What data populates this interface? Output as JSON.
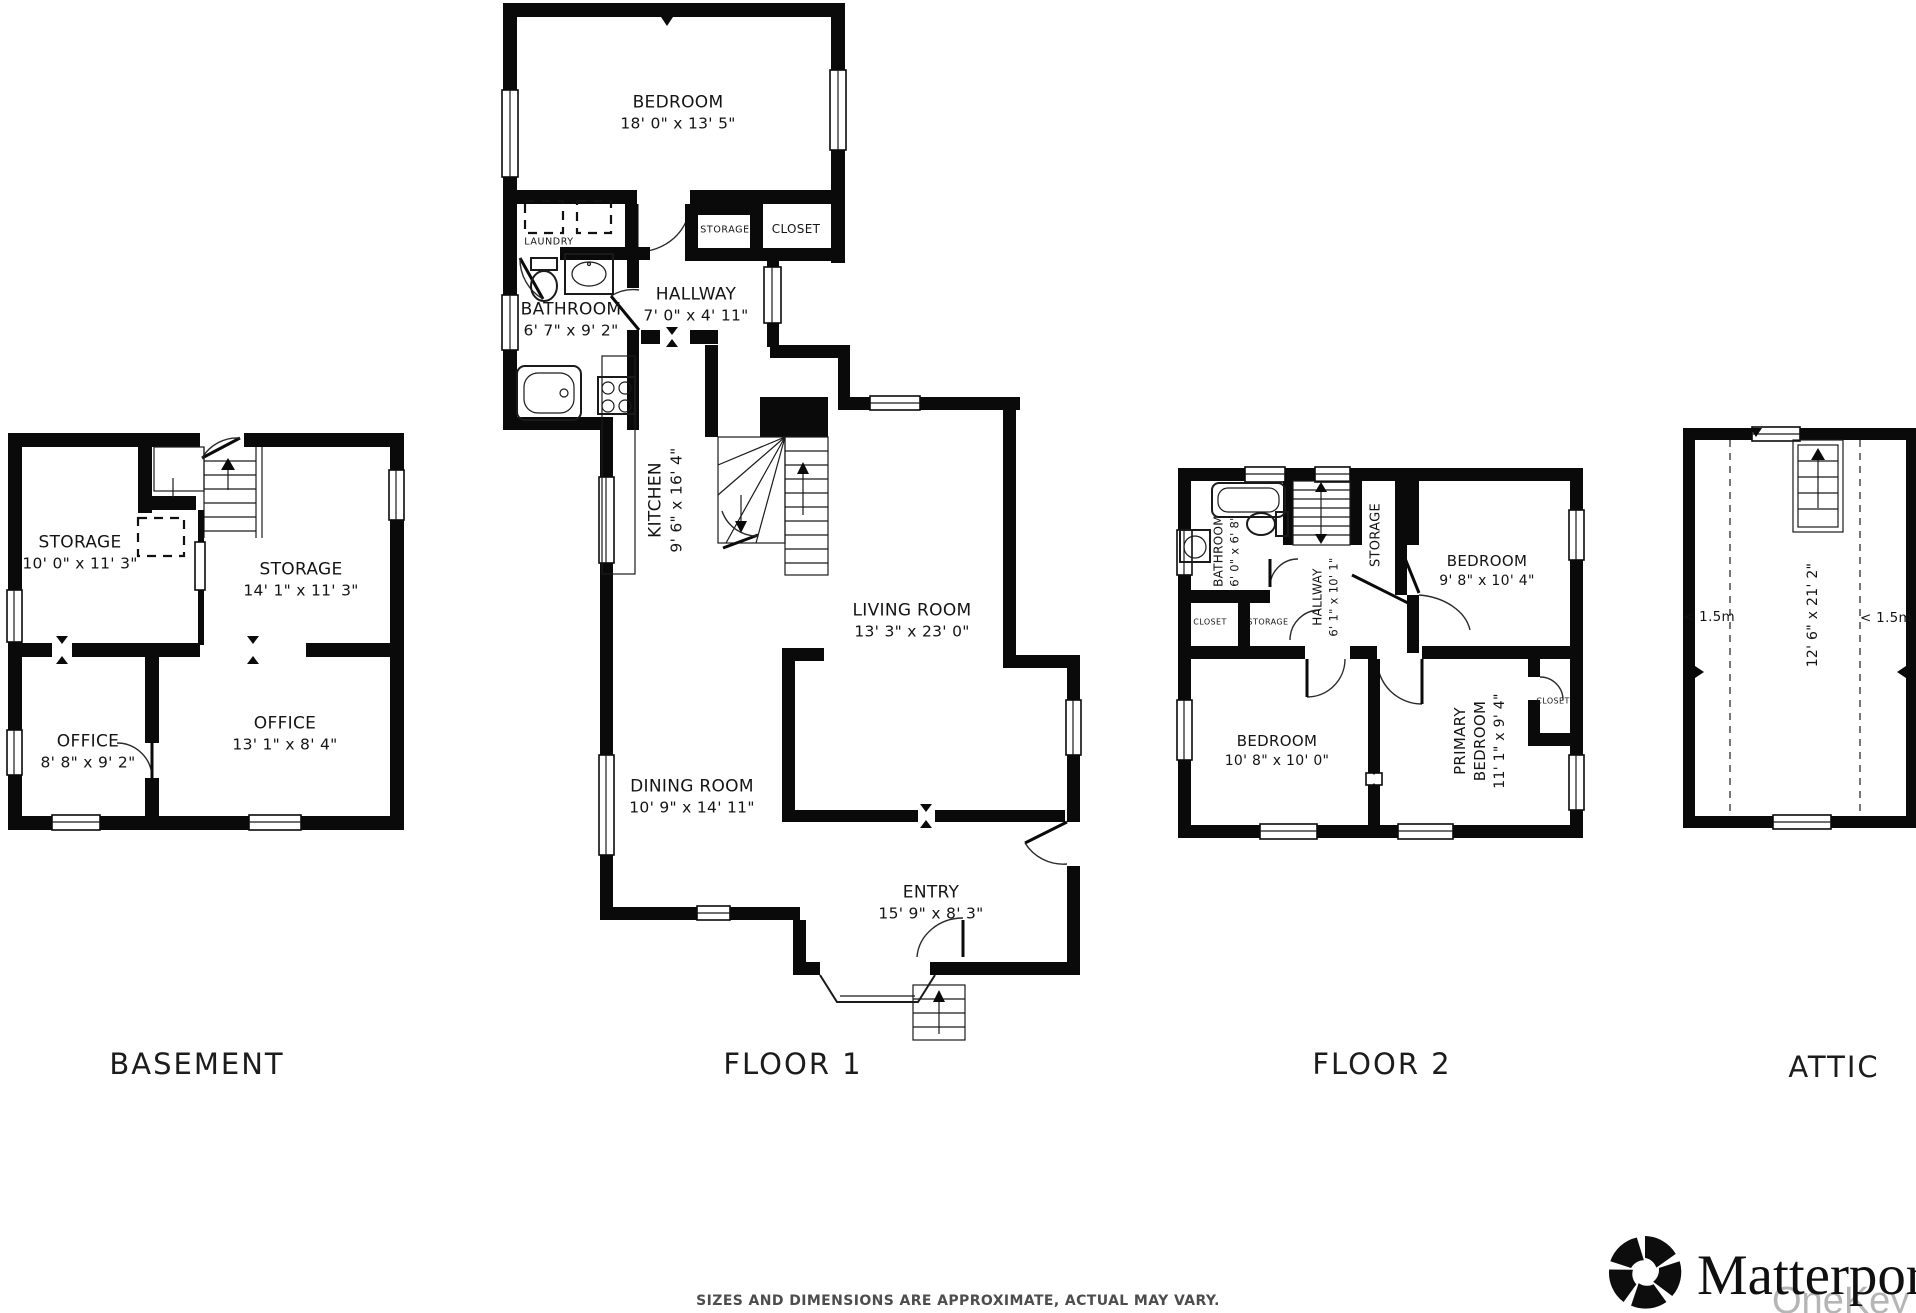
{
  "floors": {
    "basement": {
      "title": "BASEMENT",
      "storage1": {
        "name": "STORAGE",
        "dims": "10' 0\" x 11' 3\""
      },
      "storage2": {
        "name": "STORAGE",
        "dims": "14' 1\" x 11' 3\""
      },
      "office1": {
        "name": "OFFICE",
        "dims": "8' 8\" x 9' 2\""
      },
      "office2": {
        "name": "OFFICE",
        "dims": "13' 1\" x 8' 4\""
      }
    },
    "floor1": {
      "title": "FLOOR 1",
      "bedroom": {
        "name": "BEDROOM",
        "dims": "18' 0\" x 13' 5\""
      },
      "laundry": {
        "name": "LAUNDRY"
      },
      "storage": {
        "name": "STORAGE"
      },
      "closet": {
        "name": "CLOSET"
      },
      "bathroom": {
        "name": "BATHROOM",
        "dims": "6' 7\" x 9' 2\""
      },
      "hallway": {
        "name": "HALLWAY",
        "dims": "7' 0\" x 4' 11\""
      },
      "kitchen": {
        "name": "KITCHEN",
        "dims": "9' 6\" x 16' 4\""
      },
      "living": {
        "name": "LIVING ROOM",
        "dims": "13' 3\" x 23' 0\""
      },
      "dining": {
        "name": "DINING ROOM",
        "dims": "10' 9\" x 14' 11\""
      },
      "entry": {
        "name": "ENTRY",
        "dims": "15' 9\" x 8' 3\""
      }
    },
    "floor2": {
      "title": "FLOOR 2",
      "bathroom": {
        "name": "BATHROOM",
        "dims": "6' 0\" x 6' 8\""
      },
      "hallway": {
        "name": "HALLWAY",
        "dims": "6' 1\" x 10' 1\""
      },
      "storage_tall": {
        "name": "STORAGE"
      },
      "bedroom_tr": {
        "name": "BEDROOM",
        "dims": "9' 8\" x 10' 4\""
      },
      "closet": {
        "name": "CLOSET"
      },
      "storage_small": {
        "name": "STORAGE"
      },
      "bedroom_bl": {
        "name": "BEDROOM",
        "dims": "10' 8\" x 10' 0\""
      },
      "primary": {
        "line1": "PRIMARY",
        "line2": "BEDROOM",
        "dims": "11' 1\" x 9' 4\""
      },
      "closet_primary": {
        "name": "CLOSET"
      }
    },
    "attic": {
      "title": "ATTIC",
      "dims": "12' 6\" x 21' 2\"",
      "left_marker": "< 1.5m",
      "right_marker": "< 1.5m"
    }
  },
  "footer": {
    "disclaimer": "SIZES AND DIMENSIONS ARE APPROXIMATE, ACTUAL MAY VARY."
  },
  "branding": {
    "wordmark": "Matterport",
    "watermark": "OneKey M"
  }
}
